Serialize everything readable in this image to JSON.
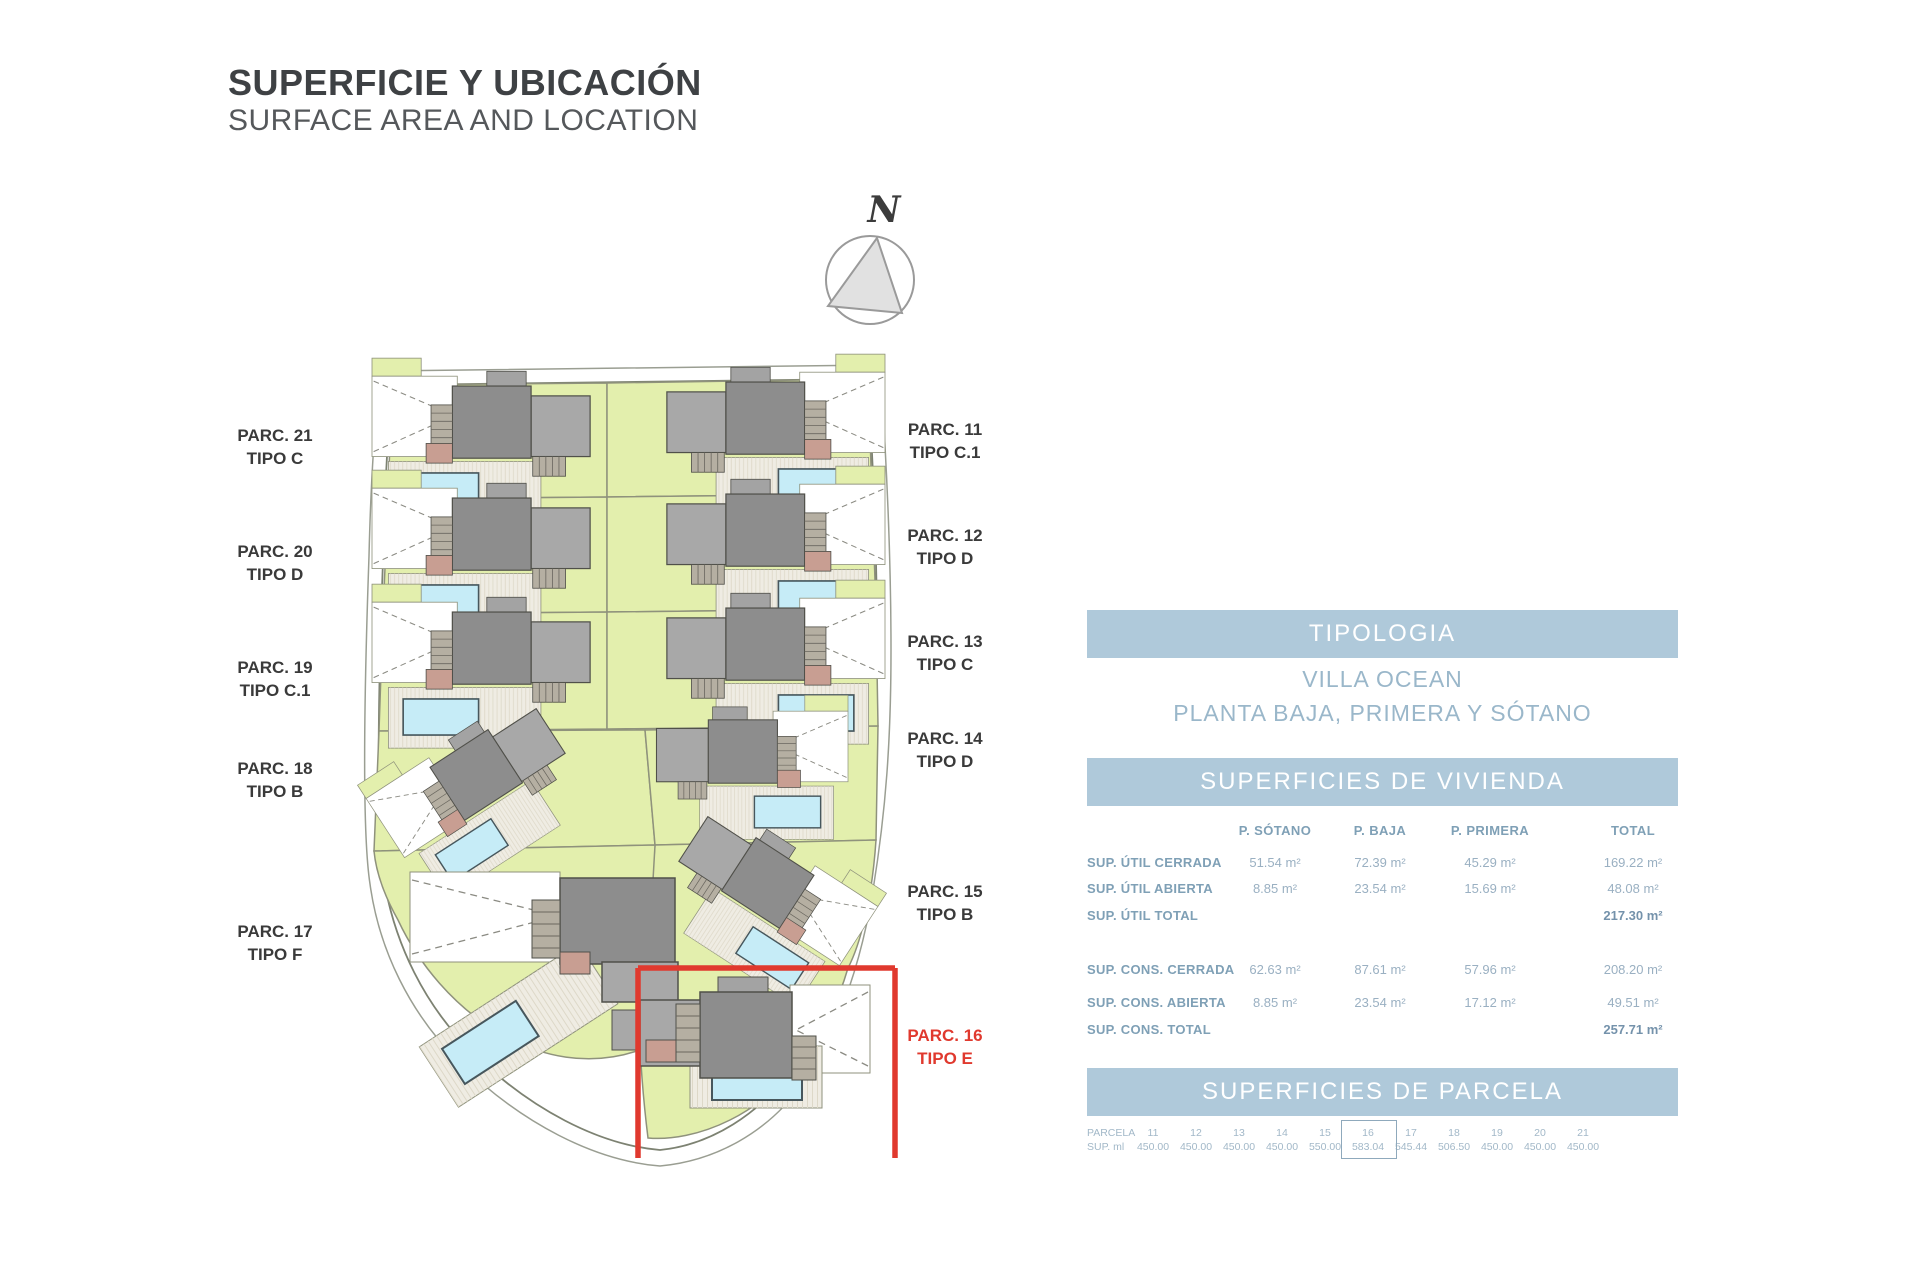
{
  "header": {
    "title": "SUPERFICIE Y UBICACIÓN",
    "subtitle": "SURFACE AREA AND LOCATION"
  },
  "compass": {
    "label": "N"
  },
  "colors": {
    "band_blue": "#afc9da",
    "highlight_red": "#e0392e",
    "garden_green": "#e3efad",
    "pool_blue": "#c6ecf7",
    "roof_gray": "#8d8d8d"
  },
  "map": {
    "labels": [
      {
        "parc": "PARC. 21",
        "tipo": "TIPO C"
      },
      {
        "parc": "PARC. 20",
        "tipo": "TIPO D"
      },
      {
        "parc": "PARC. 19",
        "tipo": "TIPO C.1"
      },
      {
        "parc": "PARC. 18",
        "tipo": "TIPO B"
      },
      {
        "parc": "PARC. 17",
        "tipo": "TIPO F"
      },
      {
        "parc": "PARC. 11",
        "tipo": "TIPO C.1"
      },
      {
        "parc": "PARC. 12",
        "tipo": "TIPO D"
      },
      {
        "parc": "PARC. 13",
        "tipo": "TIPO C"
      },
      {
        "parc": "PARC. 14",
        "tipo": "TIPO D"
      },
      {
        "parc": "PARC. 15",
        "tipo": "TIPO B"
      },
      {
        "parc": "PARC. 16",
        "tipo": "TIPO E",
        "highlighted": true
      }
    ]
  },
  "tipologia": {
    "header": "TIPOLOGIA",
    "name": "VILLA OCEAN",
    "floors": "PLANTA BAJA, PRIMERA Y SÓTANO"
  },
  "vivienda": {
    "header": "SUPERFICIES DE VIVIENDA",
    "columns": [
      "P. SÓTANO",
      "P. BAJA",
      "P. PRIMERA",
      "TOTAL"
    ],
    "rows": [
      {
        "label": "SUP. ÚTIL CERRADA",
        "sotano": "51.54 m²",
        "baja": "72.39 m²",
        "primera": "45.29 m²",
        "total": "169.22 m²"
      },
      {
        "label": "SUP. ÚTIL ABIERTA",
        "sotano": "8.85 m²",
        "baja": "23.54 m²",
        "primera": "15.69 m²",
        "total": "48.08 m²"
      },
      {
        "label": "SUP. ÚTIL TOTAL",
        "sotano": "",
        "baja": "",
        "primera": "",
        "total": "217.30 m²"
      },
      {
        "label": "SUP. CONS. CERRADA",
        "sotano": "62.63 m²",
        "baja": "87.61 m²",
        "primera": "57.96 m²",
        "total": "208.20 m²"
      },
      {
        "label": "SUP. CONS. ABIERTA",
        "sotano": "8.85 m²",
        "baja": "23.54 m²",
        "primera": "17.12 m²",
        "total": "49.51 m²"
      },
      {
        "label": "SUP. CONS. TOTAL",
        "sotano": "",
        "baja": "",
        "primera": "",
        "total": "257.71 m²"
      }
    ]
  },
  "parcela": {
    "header": "SUPERFICIES DE PARCELA",
    "row1_label": "PARCELA",
    "row2_label": "SUP. ml",
    "highlighted_num": "16",
    "columns": [
      {
        "num": "11",
        "sup": "450.00"
      },
      {
        "num": "12",
        "sup": "450.00"
      },
      {
        "num": "13",
        "sup": "450.00"
      },
      {
        "num": "14",
        "sup": "450.00"
      },
      {
        "num": "15",
        "sup": "550.00"
      },
      {
        "num": "16",
        "sup": "583.04"
      },
      {
        "num": "17",
        "sup": "545.44"
      },
      {
        "num": "18",
        "sup": "506.50"
      },
      {
        "num": "19",
        "sup": "450.00"
      },
      {
        "num": "20",
        "sup": "450.00"
      },
      {
        "num": "21",
        "sup": "450.00"
      }
    ]
  }
}
